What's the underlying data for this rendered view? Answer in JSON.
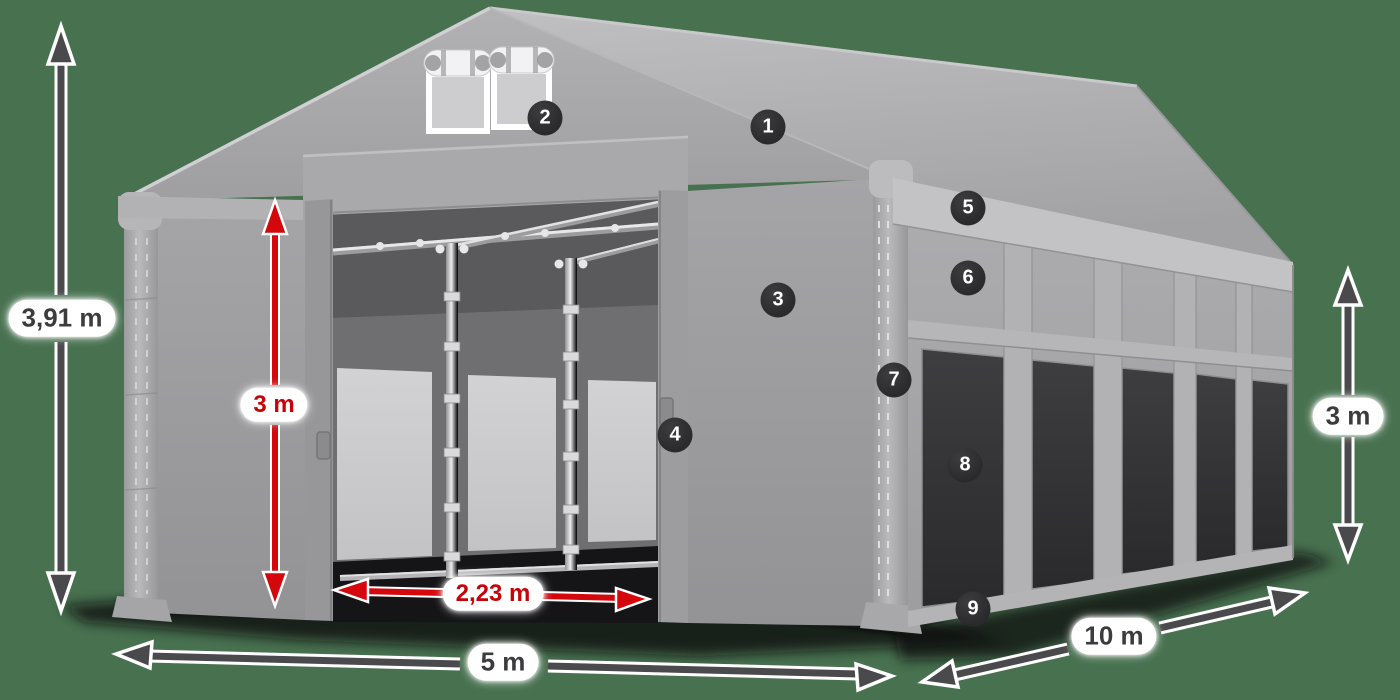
{
  "dimensions": {
    "total_height": "3,91 m",
    "door_height": "3 m",
    "door_width": "2,23 m",
    "front_width": "5 m",
    "side_length": "10 m",
    "side_wall_height": "3 m"
  },
  "markers": [
    {
      "number": "1"
    },
    {
      "number": "2"
    },
    {
      "number": "3"
    },
    {
      "number": "4"
    },
    {
      "number": "5"
    },
    {
      "number": "6"
    },
    {
      "number": "7"
    },
    {
      "number": "8"
    },
    {
      "number": "9"
    }
  ],
  "colors": {
    "background": "#487150",
    "dimension_red": "#d4070c",
    "dimension_gray": "#4a4a4c",
    "marker_background": "#2d2d2f",
    "pill_background": "#ffffff",
    "pill_text": "#3c3c3e",
    "tent_gray": "#a7a7aa"
  }
}
